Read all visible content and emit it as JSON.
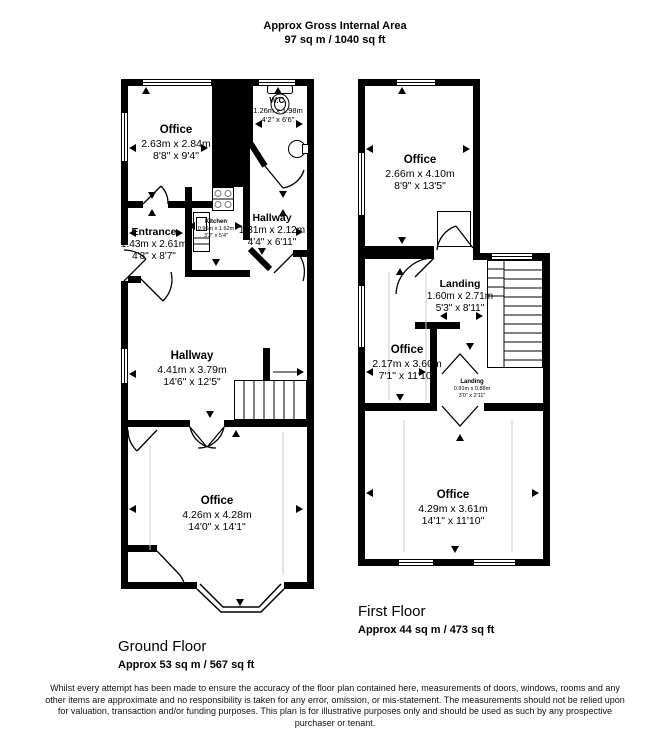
{
  "title": {
    "line1": "Approx Gross Internal Area",
    "line2": "97 sq m / 1040 sq ft"
  },
  "floors": {
    "ground": {
      "label": "Ground Floor",
      "area": "Approx 53 sq m / 567 sq ft",
      "rooms": {
        "office_top": {
          "name": "Office",
          "metric": "2.63m x 2.84m",
          "imperial": "8'8\" x 9'4\""
        },
        "wc": {
          "name": "W.C.",
          "metric": "1.26m x 1.98m",
          "imperial": "4'2\" x 6'6\""
        },
        "entrance": {
          "name": "Entrance",
          "metric": "1.43m x 2.61m",
          "imperial": "4'8\" x 8'7\""
        },
        "kitchen": {
          "name": "Kitchen",
          "metric": "0.96m x 1.62m",
          "imperial": "3'2\" x 5'4\""
        },
        "hallway_small": {
          "name": "Hallway",
          "metric": "1.31m x 2.12m",
          "imperial": "4'4\" x 6'11\""
        },
        "hallway_main": {
          "name": "Hallway",
          "metric": "4.41m x 3.79m",
          "imperial": "14'6\" x 12'5\""
        },
        "office_bottom": {
          "name": "Office",
          "metric": "4.26m x 4.28m",
          "imperial": "14'0\" x 14'1\""
        }
      }
    },
    "first": {
      "label": "First Floor",
      "area": "Approx 44 sq m / 473 sq ft",
      "rooms": {
        "office_top": {
          "name": "Office",
          "metric": "2.66m x 4.10m",
          "imperial": "8'9\" x 13'5\""
        },
        "landing": {
          "name": "Landing",
          "metric": "1.60m x 2.71m",
          "imperial": "5'3\" x 8'11\""
        },
        "office_mid": {
          "name": "Office",
          "metric": "2.17m x 3.60m",
          "imperial": "7'1\" x 11'10\""
        },
        "landing_small": {
          "name": "Landing",
          "metric": "0.91m x 0.88m",
          "imperial": "3'0\" x 2'11\""
        },
        "office_bottom": {
          "name": "Office",
          "metric": "4.29m x 3.61m",
          "imperial": "14'1\" x 11'10\""
        }
      }
    }
  },
  "icons": {
    "wc_toilet": "toilet-icon",
    "wc_sink": "sink-icon",
    "kitchen_stove": "stove-icon",
    "kitchen_sink": "sink-icon",
    "ground_stairs": "stairs-icon",
    "first_stairs": "stairs-icon"
  },
  "colors": {
    "wall": "#000000",
    "background": "#ffffff",
    "floor_line": "#c8c8c8",
    "burner": "#777777"
  },
  "disclaimer": "Whilst every attempt has been made to ensure the accuracy of the floor plan contained here, measurements of doors, windows, rooms and any other items are approximate and no responsibility is taken for any error, omission, or mis-statement. The measurements should not be relied upon for valuation, transaction and/or funding purposes. This plan is for illustrative purposes only and should be used as such by any prospective purchaser or tenant."
}
